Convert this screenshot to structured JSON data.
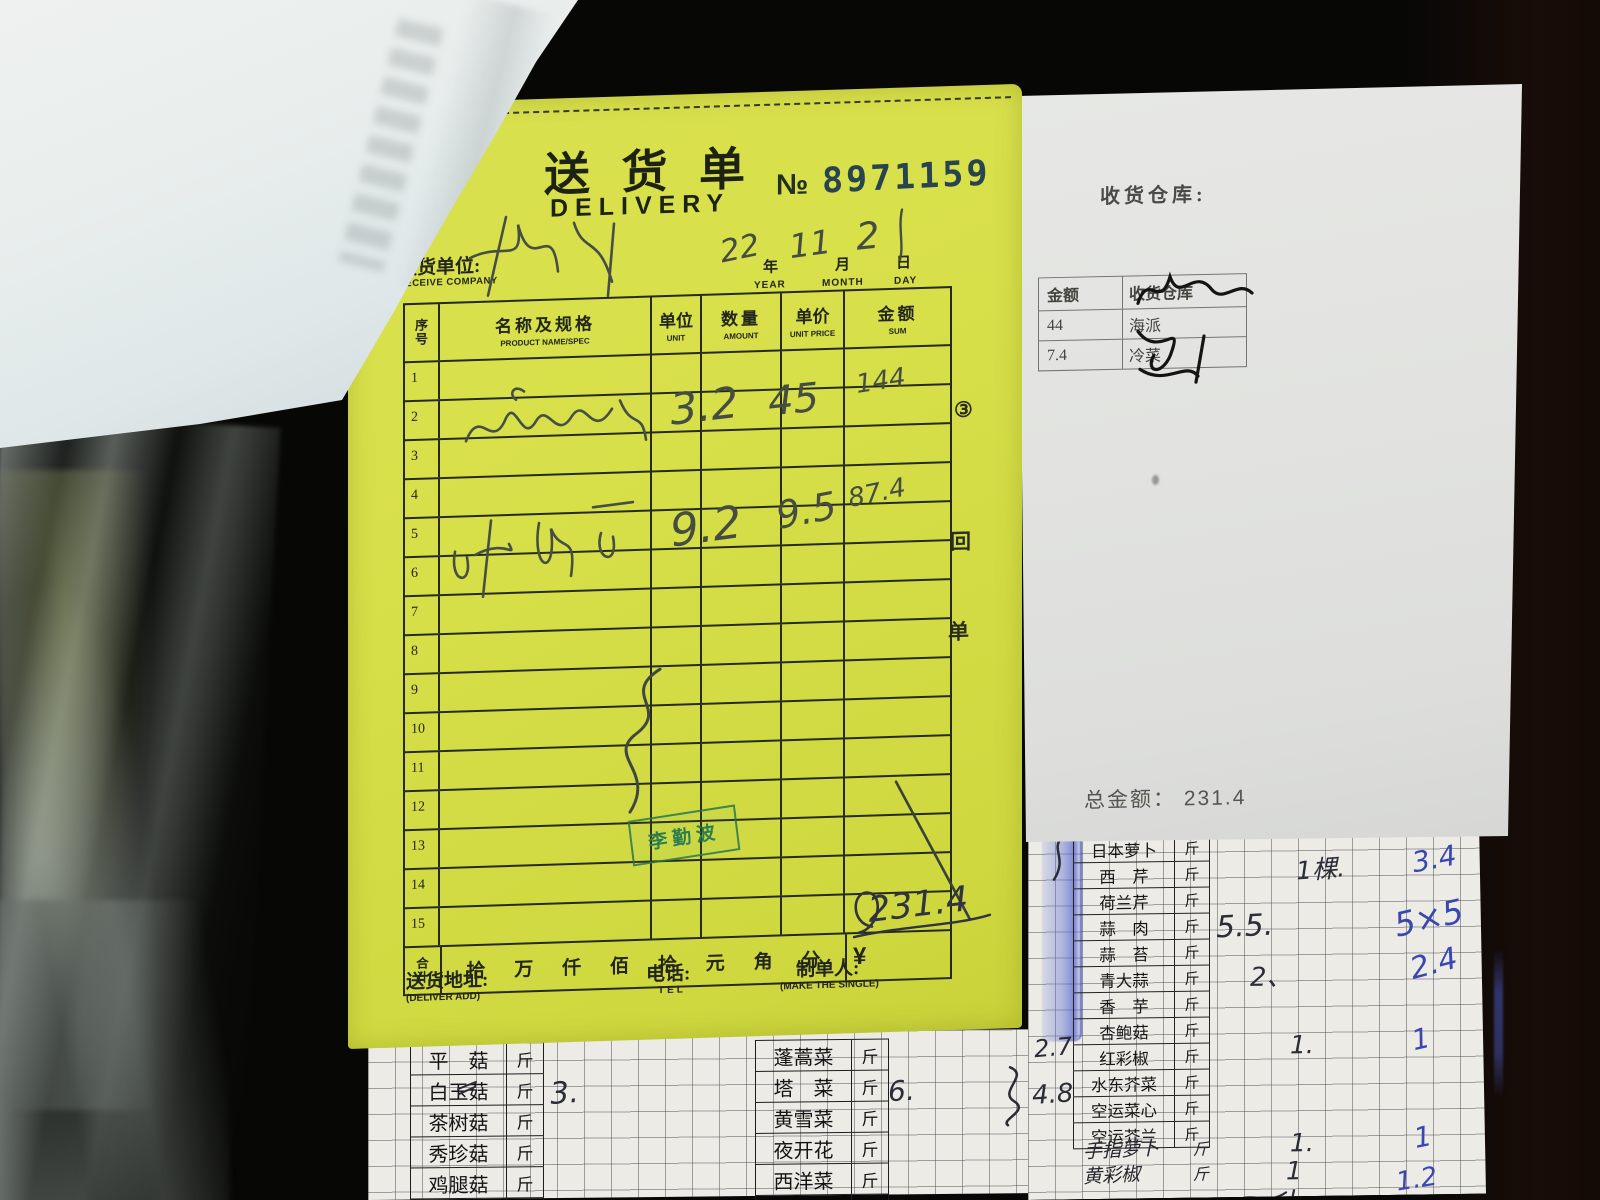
{
  "colors": {
    "slip_yellow": "#d7df49",
    "stamp_green": "#2e7d4e",
    "pen_blue": "#3a47b0",
    "stamp_number_ink": "#274450"
  },
  "slip": {
    "title_cn": "送 货 单",
    "title_en": "DELIVERY",
    "no_label": "№",
    "no_value": "8971159",
    "receive_label_cn": "收货单位:",
    "receive_label_en": "RECEIVE COMPANY",
    "date": {
      "year_hw": "22",
      "year_cn": "年",
      "year_en": "YEAR",
      "month_hw": "11",
      "month_cn": "月",
      "month_en": "MONTH",
      "day_hw": "2",
      "day_cn": "日",
      "day_en": "DAY"
    },
    "columns": {
      "index_top": "序",
      "index_bottom": "号",
      "name_cn": "名称及规格",
      "name_en": "PRODUCT NAME/SPEC",
      "unit_cn": "单位",
      "unit_en": "UNIT",
      "qty_cn": "数量",
      "qty_en": "AMOUNT",
      "price_cn": "单价",
      "price_en": "UNIT PRICE",
      "sum_cn": "金额",
      "sum_en": "SUM"
    },
    "row_numbers": [
      "1",
      "2",
      "3",
      "4",
      "5",
      "6",
      "7",
      "8",
      "9",
      "10",
      "11",
      "12",
      "13",
      "14",
      "15"
    ],
    "entries": [
      {
        "qty": "3.2",
        "price": "45",
        "sum": "144"
      },
      {
        "qty": "9.2",
        "price": "9.5",
        "sum": "87.4"
      }
    ],
    "copy_marks": [
      "③",
      "回",
      "单"
    ],
    "total": {
      "label_top": "合",
      "label_bottom": "计",
      "units": [
        "拾",
        "万",
        "仟",
        "佰",
        "拾",
        "元",
        "角",
        "分"
      ],
      "currency": "¥",
      "amount_hw": "231.4"
    },
    "stamp_name": "李勤波",
    "footer": {
      "address_cn": "送货地址:",
      "address_en": "(DELIVER ADD)",
      "tel_cn": "电话:",
      "tel_en": "TEL",
      "maker_cn": "制单人:",
      "maker_en": "(MAKE THE SINGLE)"
    }
  },
  "warehouse_note": {
    "title": "收货仓库:",
    "table": {
      "col_amount": "金额",
      "col_warehouse": "收货仓库",
      "rows": [
        {
          "amount": "44",
          "warehouse": "海派"
        },
        {
          "amount": "7.4",
          "warehouse": "冷菜"
        }
      ]
    },
    "total_label": "总金额：",
    "total_value": "231.4"
  },
  "grid_left": {
    "col_a": [
      {
        "name": "平　菇",
        "unit": "斤"
      },
      {
        "name": "白玉菇",
        "unit": "斤"
      },
      {
        "name": "茶树菇",
        "unit": "斤"
      },
      {
        "name": "秀珍菇",
        "unit": "斤"
      },
      {
        "name": "鸡腿菇",
        "unit": "斤"
      },
      {
        "name": "香　菇",
        "unit": "斤"
      }
    ],
    "col_b": [
      {
        "name": "蓬蒿菜",
        "unit": "斤"
      },
      {
        "name": "塔　菜",
        "unit": "斤"
      },
      {
        "name": "黄雪菜",
        "unit": "斤"
      },
      {
        "name": "夜开花",
        "unit": "斤"
      },
      {
        "name": "西洋菜",
        "unit": "斤"
      },
      {
        "name": "百　合",
        "unit": "斤"
      }
    ],
    "hw": {
      "baiyugu_qty": "3.",
      "tacai_qty": "6."
    }
  },
  "grid_right": {
    "rows": [
      {
        "name": "日本萝卜",
        "unit": "斤"
      },
      {
        "name": "西　芹",
        "unit": "斤"
      },
      {
        "name": "荷兰芹",
        "unit": "斤"
      },
      {
        "name": "蒜　肉",
        "unit": "斤"
      },
      {
        "name": "蒜　苔",
        "unit": "斤"
      },
      {
        "name": "青大蒜",
        "unit": "斤"
      },
      {
        "name": "香　芋",
        "unit": "斤"
      },
      {
        "name": "杏鲍菇",
        "unit": "斤"
      },
      {
        "name": "红彩椒",
        "unit": "斤"
      },
      {
        "name": "水东芥菜",
        "unit": "斤"
      },
      {
        "name": "空运菜心",
        "unit": "斤"
      },
      {
        "name": "空运芥兰",
        "unit": "斤"
      }
    ],
    "hw_rows": [
      {
        "name": "手指萝卜",
        "unit": "斤"
      },
      {
        "name": "黄彩椒",
        "unit": "斤"
      }
    ],
    "hw": {
      "xiqin_qty": "1棵.",
      "xiqin_sum": "3.4",
      "suanrou_qty": "5.5.",
      "suanrou_sum": "5×5",
      "qingdasuan_qty": "2、",
      "qingdasuan_sum": "2.4",
      "hongcaijiao_left": "2.7",
      "hongcaijiao_qty": "1.",
      "hongcaijiao_sum": "1",
      "kongyuncaixin_left": "4.8",
      "shouzhi_qty": "1.",
      "shouzhi_sum": "1",
      "huangcaijiao_qty": "1",
      "huangcaijiao_sum": "1.2"
    }
  }
}
